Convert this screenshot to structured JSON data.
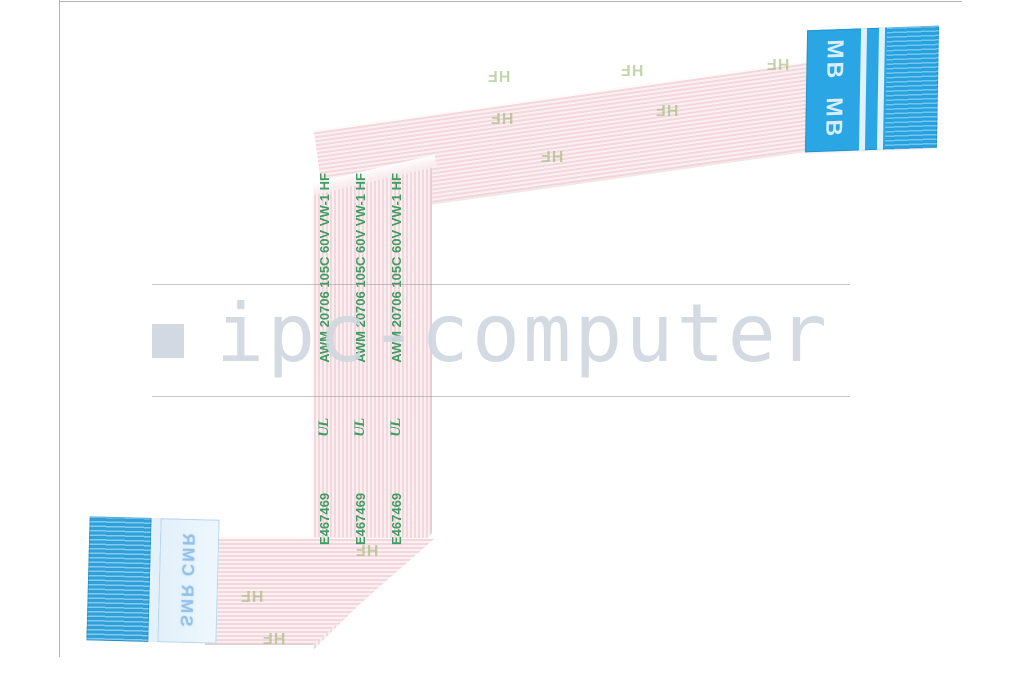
{
  "image": {
    "type": "product-photo",
    "subject": "Flex flat ribbon cable (FFC) with blue connector stiffeners",
    "background_color": "#ffffff"
  },
  "watermark": {
    "brand": "ipc-computer",
    "text_color": "#d0d7df",
    "square_color": "#d2d9e2"
  },
  "cable": {
    "film_color": "#f7e5e8",
    "stripe_color": "#f2d8dd",
    "print_color": "#3f9c62",
    "marking": {
      "cert": "E467469",
      "ul": "UL",
      "spec": "AWM 20706 105C 60V VW-1 HF"
    },
    "hf_mark": "HF"
  },
  "connectors": {
    "mb": {
      "label": "MB",
      "body_color": "#2aa6e5"
    },
    "sm": {
      "label": "SMR CMR",
      "body_color": "#33a7e1",
      "panel_color": "#eef7fd"
    }
  }
}
